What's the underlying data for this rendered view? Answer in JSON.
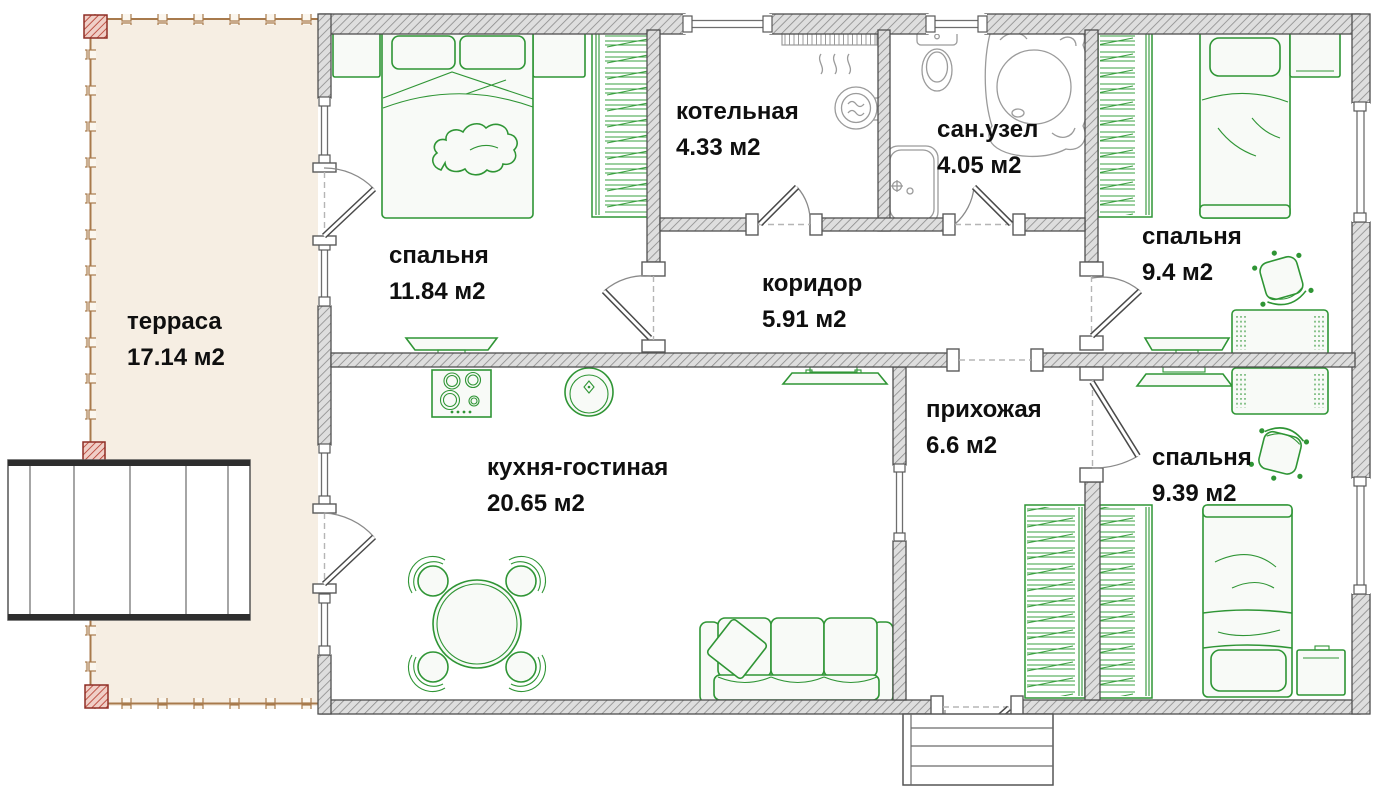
{
  "plan": {
    "title": "house floor plan",
    "rooms": [
      {
        "id": "terrace",
        "name": "терраса",
        "area": "17.14 м2"
      },
      {
        "id": "bedroom-1",
        "name": "спальня",
        "area": "11.84 м2"
      },
      {
        "id": "boiler-room",
        "name": "котельная",
        "area": "4.33 м2"
      },
      {
        "id": "bathroom",
        "name": "сан.узел",
        "area": "4.05 м2"
      },
      {
        "id": "bedroom-2",
        "name": "спальня",
        "area": "9.4 м2"
      },
      {
        "id": "corridor",
        "name": "коридор",
        "area": "5.91 м2"
      },
      {
        "id": "kitchen-living",
        "name": "кухня-гостиная",
        "area": "20.65 м2"
      },
      {
        "id": "hallway",
        "name": "прихожая",
        "area": "6.6 м2"
      },
      {
        "id": "bedroom-3",
        "name": "спальня",
        "area": "9.39 м2"
      }
    ],
    "colors": {
      "furniture_green": "#2f9535",
      "fixture_gray": "#9b9b9b",
      "wall_fill": "#dedede",
      "wall_hatch_line": "#8a8a8a",
      "terrace_fill": "#f6eee3",
      "deck_brown": "#a87a4c",
      "corner_post_red": "#b23527",
      "label_text": "#0f0f0f"
    }
  }
}
